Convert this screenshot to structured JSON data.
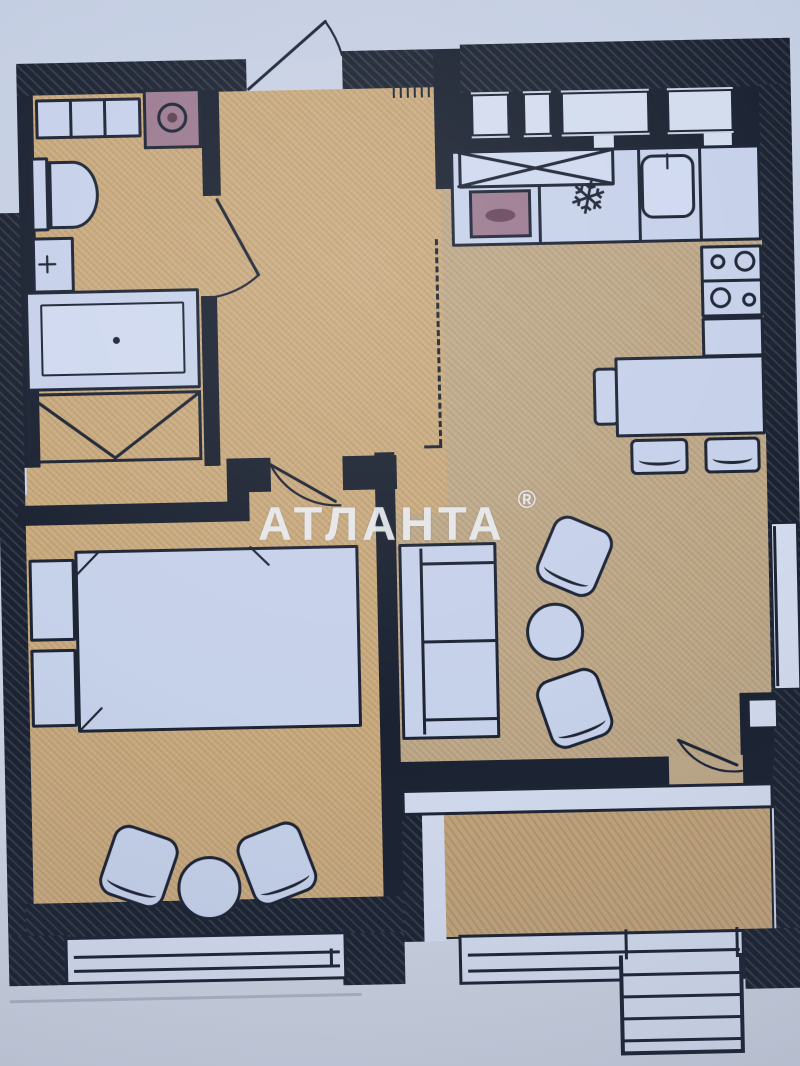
{
  "watermark": {
    "text": "АТЛАНТА",
    "reg": "®"
  },
  "icons": {
    "snowflake": "❄"
  },
  "colors": {
    "paper": "#c7d0e3",
    "wall": "#1b2231",
    "outline": "#1d2434",
    "floor_main": "#c9aa7e",
    "floor_living": "#bda888",
    "floor_terrace": "#c2a47c",
    "furniture_fill": "#c6d1ea",
    "furniture_fill_bright": "#cfd9ef",
    "window": "#d3dcee",
    "appliance": "#9b7a90",
    "watermark": "#eaecf1"
  }
}
